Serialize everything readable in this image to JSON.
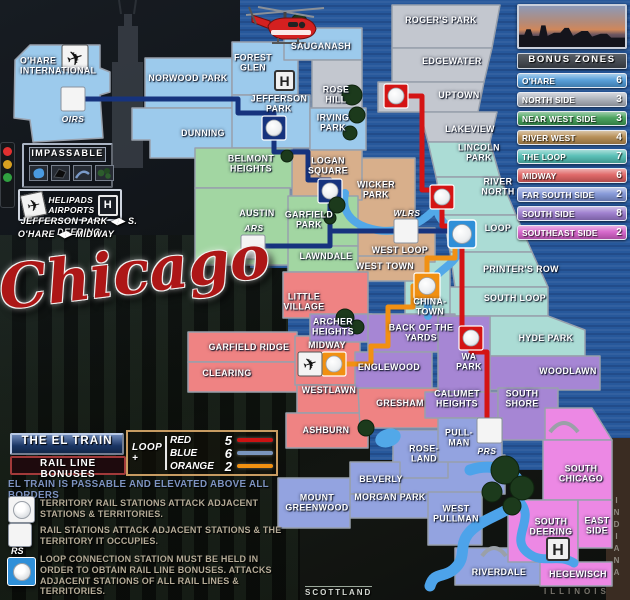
{
  "title": "Chicago",
  "watermark": "SCOTTLAND",
  "state_labels": {
    "indiana": "INDIANA",
    "illinois": "ILLINOIS"
  },
  "bonus_panel": {
    "header": "BONUS ZONES",
    "zones": [
      {
        "label": "O'HARE",
        "value": "6",
        "color": "#4e9ad8"
      },
      {
        "label": "NORTH SIDE",
        "value": "3",
        "color": "#aab0ba"
      },
      {
        "label": "NEAR WEST SIDE",
        "value": "3",
        "color": "#3f9d55"
      },
      {
        "label": "RIVER WEST",
        "value": "4",
        "color": "#b3894e"
      },
      {
        "label": "THE LOOP",
        "value": "7",
        "color": "#4fbcb2"
      },
      {
        "label": "MIDWAY",
        "value": "6",
        "color": "#de5f5f"
      },
      {
        "label": "FAR SOUTH SIDE",
        "value": "2",
        "color": "#7f93d6"
      },
      {
        "label": "SOUTH SIDE",
        "value": "8",
        "color": "#9a79cd"
      },
      {
        "label": "SOUTHEAST SIDE",
        "value": "2",
        "color": "#d45fc9"
      }
    ]
  },
  "impassable": {
    "title": "IMPASSABLE"
  },
  "helipads": {
    "line1": "HELIPADS",
    "line2": "AIRPORTS",
    "h_letter": "H"
  },
  "shortcuts": [
    "JEFFERSON PARK ◀▶ S. DEERING",
    "O'HARE ◀▶ MIDWAY"
  ],
  "el_legend": {
    "title": "THE EL TRAIN",
    "subtitle": "RAIL LINE BONUSES",
    "loop_label": "LOOP +",
    "lines": [
      {
        "name": "RED",
        "bonus": "5",
        "color": "#cc1212"
      },
      {
        "name": "BLUE",
        "bonus": "6",
        "color": "#7a95bd"
      },
      {
        "name": "ORANGE",
        "bonus": "2",
        "color": "#f29111"
      }
    ],
    "note": "EL TRAIN IS PASSABLE AND ELEVATED ABOVE ALL BORDERS",
    "rules": [
      "TERRITORY RAIL STATIONS ATTACK ADJACENT STATIONS & TERRITORIES.",
      "RAIL STATIONS ATTACK ADJACENT STATIONS & THE TERRITORY IT OCCUPIES.",
      "LOOP CONNECTION STATION MUST BE HELD IN ORDER TO OBTAIN RAIL LINE BONUSES. ATTACKS ADJACENT STATIONS OF ALL RAIL LINES & TERRITORIES."
    ],
    "rs_label": "RS"
  },
  "stations": {
    "oirs": "OIRS",
    "ars": "ARS",
    "wlrs": "WLRS",
    "prs": "PRS"
  },
  "zone_colors": {
    "ohare": "#9ccaec",
    "north": "#c3c7cf",
    "nearwest": "#a2d6a2",
    "riverwest": "#d8af8b",
    "loop": "#abdcd5",
    "midway": "#ef8383",
    "farsouth": "#93a3e0",
    "south": "#a686d4",
    "southeast": "#ec88e4",
    "water": "#27589b",
    "indiana": "#3a2c22"
  },
  "map": {
    "territories": [
      {
        "name": "O'HARE\nINTERNATIONAL",
        "zone": "ohare"
      },
      {
        "name": "NORWOOD PARK",
        "zone": "ohare"
      },
      {
        "name": "DUNNING",
        "zone": "ohare"
      },
      {
        "name": "FOREST\nGLEN",
        "zone": "ohare"
      },
      {
        "name": "SAUGANASH",
        "zone": "ohare"
      },
      {
        "name": "JEFFERSON\nPARK",
        "zone": "ohare"
      },
      {
        "name": "ROSE\nHILL",
        "zone": "north"
      },
      {
        "name": "IRVING\nPARK",
        "zone": "ohare"
      },
      {
        "name": "ROGER'S PARK",
        "zone": "north"
      },
      {
        "name": "EDGEWATER",
        "zone": "north"
      },
      {
        "name": "UPTOWN",
        "zone": "north"
      },
      {
        "name": "LAKEVIEW",
        "zone": "north"
      },
      {
        "name": "LINCOLN\nPARK",
        "zone": "loop"
      },
      {
        "name": "RIVER\nNORTH",
        "zone": "loop"
      },
      {
        "name": "LOOP",
        "zone": "loop"
      },
      {
        "name": "PRINTER'S ROW",
        "zone": "loop"
      },
      {
        "name": "SOUTH LOOP",
        "zone": "loop"
      },
      {
        "name": "HYDE PARK",
        "zone": "loop"
      },
      {
        "name": "CHINA-\nTOWN",
        "zone": "loop"
      },
      {
        "name": "LOGAN\nSQUARE",
        "zone": "riverwest"
      },
      {
        "name": "WICKER\nPARK",
        "zone": "riverwest"
      },
      {
        "name": "WEST LOOP",
        "zone": "riverwest"
      },
      {
        "name": "WEST TOWN",
        "zone": "riverwest"
      },
      {
        "name": "BELMONT\nHEIGHTS",
        "zone": "nearwest"
      },
      {
        "name": "AUSTIN",
        "zone": "nearwest"
      },
      {
        "name": "GARFIELD\nPARK",
        "zone": "nearwest"
      },
      {
        "name": "LAWNDALE",
        "zone": "nearwest"
      },
      {
        "name": "LITTLE\nVILLAGE",
        "zone": "midway"
      },
      {
        "name": "GARFIELD RIDGE",
        "zone": "midway"
      },
      {
        "name": "CLEARING",
        "zone": "midway"
      },
      {
        "name": "MIDWAY",
        "zone": "midway"
      },
      {
        "name": "WESTLAWN",
        "zone": "midway"
      },
      {
        "name": "ASHBURN",
        "zone": "midway"
      },
      {
        "name": "GRESHAM",
        "zone": "midway"
      },
      {
        "name": "ARCHER\nHEIGHTS",
        "zone": "south"
      },
      {
        "name": "BACK OF THE\nYARDS",
        "zone": "south"
      },
      {
        "name": "ENGLEWOOD",
        "zone": "south"
      },
      {
        "name": "WA\nPARK",
        "zone": "south"
      },
      {
        "name": "WOODLAWN",
        "zone": "south"
      },
      {
        "name": "CALUMET\nHEIGHTS",
        "zone": "south"
      },
      {
        "name": "SOUTH\nSHORE",
        "zone": "south"
      },
      {
        "name": "ROSE-\nLAND",
        "zone": "farsouth"
      },
      {
        "name": "BEVERLY",
        "zone": "farsouth"
      },
      {
        "name": "MORGAN PARK",
        "zone": "farsouth"
      },
      {
        "name": "MOUNT\nGREENWOOD",
        "zone": "farsouth"
      },
      {
        "name": "PULL-\nMAN",
        "zone": "farsouth"
      },
      {
        "name": "WEST\nPULLMAN",
        "zone": "farsouth"
      },
      {
        "name": "RIVERDALE",
        "zone": "farsouth"
      },
      {
        "name": "SOUTH\nCHICAGO",
        "zone": "southeast"
      },
      {
        "name": "SOUTH\nDEERING",
        "zone": "southeast"
      },
      {
        "name": "EAST\nSIDE",
        "zone": "southeast"
      },
      {
        "name": "HEGEWISCH",
        "zone": "southeast"
      }
    ]
  }
}
